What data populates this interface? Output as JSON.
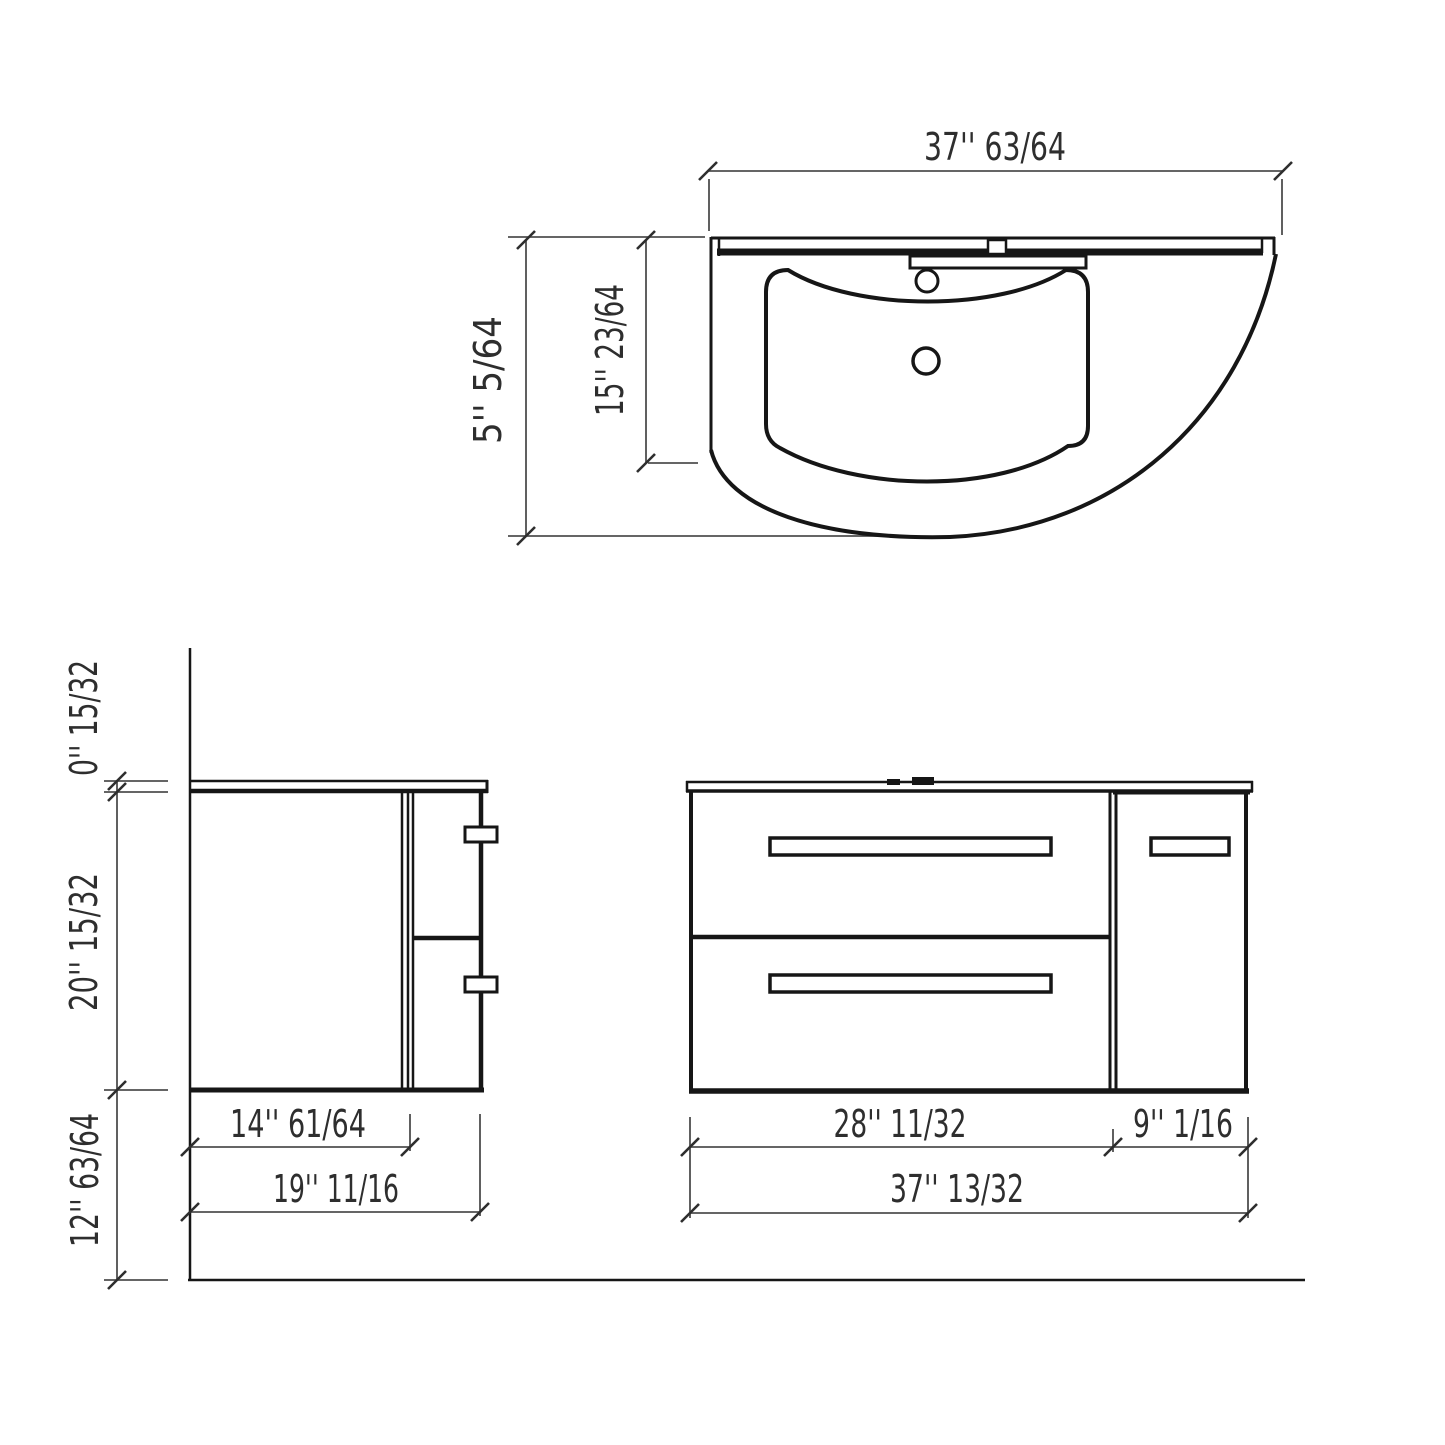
{
  "drawing": {
    "top_view": {
      "width": "37'' 63/64",
      "overall_depth": "5'' 5/64",
      "basin_depth": "15'' 23/64"
    },
    "side_view": {
      "countertop_thickness": "0'' 15/32",
      "cabinet_height": "20'' 15/32",
      "clearance_below": "12'' 63/64",
      "cabinet_depth": "14'' 61/64",
      "overall_depth": "19'' 11/16"
    },
    "front_view": {
      "drawer_section_width": "28'' 11/32",
      "door_section_width": "9'' 1/16",
      "overall_width": "37'' 13/32"
    }
  },
  "colors": {
    "background": "#ffffff",
    "object_line": "#161616",
    "dimension_line": "#4f4f4f",
    "text": "#2e2e2e"
  }
}
